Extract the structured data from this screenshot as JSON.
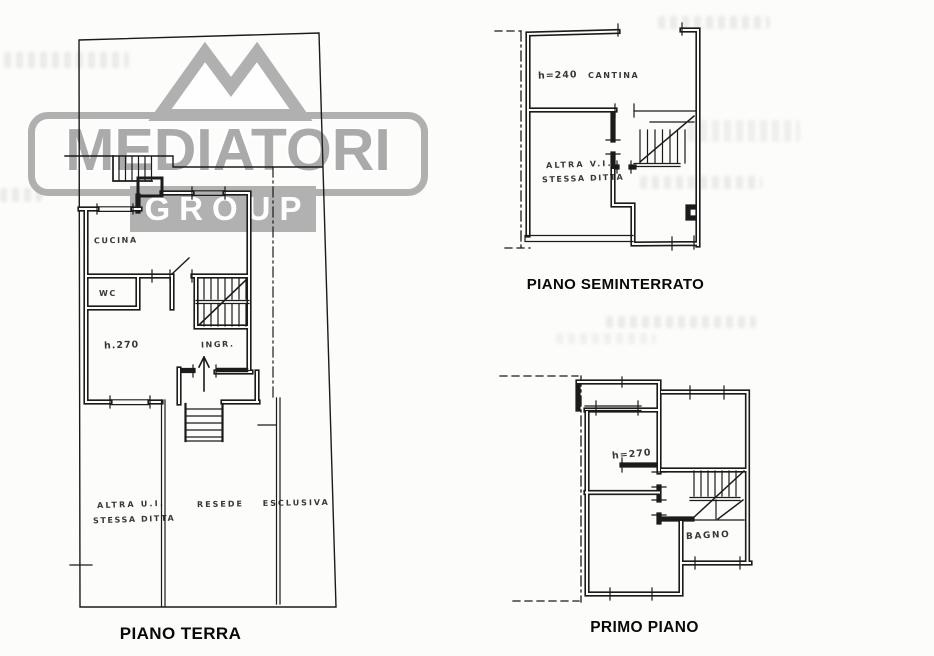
{
  "watermark": {
    "brand": "MEDIATORI",
    "subbrand": "GROUP",
    "logo_icon": "mountain-peaks-icon",
    "color": "#a8a8a8"
  },
  "plans": {
    "terra": {
      "caption": "PIANO TERRA",
      "rooms": {
        "cucina": "CUCINA",
        "wc": "WC",
        "height": "h.270",
        "ingresso": "INGR.",
        "altra_ui_line1": "ALTRA U.I.",
        "altra_ui_line2": "STESSA DITTA",
        "resede": "RESEDE ESCLUSIVA"
      }
    },
    "seminterrato": {
      "caption": "PIANO SEMINTERRATO",
      "rooms": {
        "height": "h=240",
        "cantina": "CANTINA",
        "altra_ui_line1": "ALTRA V.I.",
        "altra_ui_line2": "STESSA DITTA"
      }
    },
    "primo": {
      "caption": "PRIMO PIANO",
      "rooms": {
        "height": "h=270",
        "bagno": "BAGNO"
      }
    }
  }
}
